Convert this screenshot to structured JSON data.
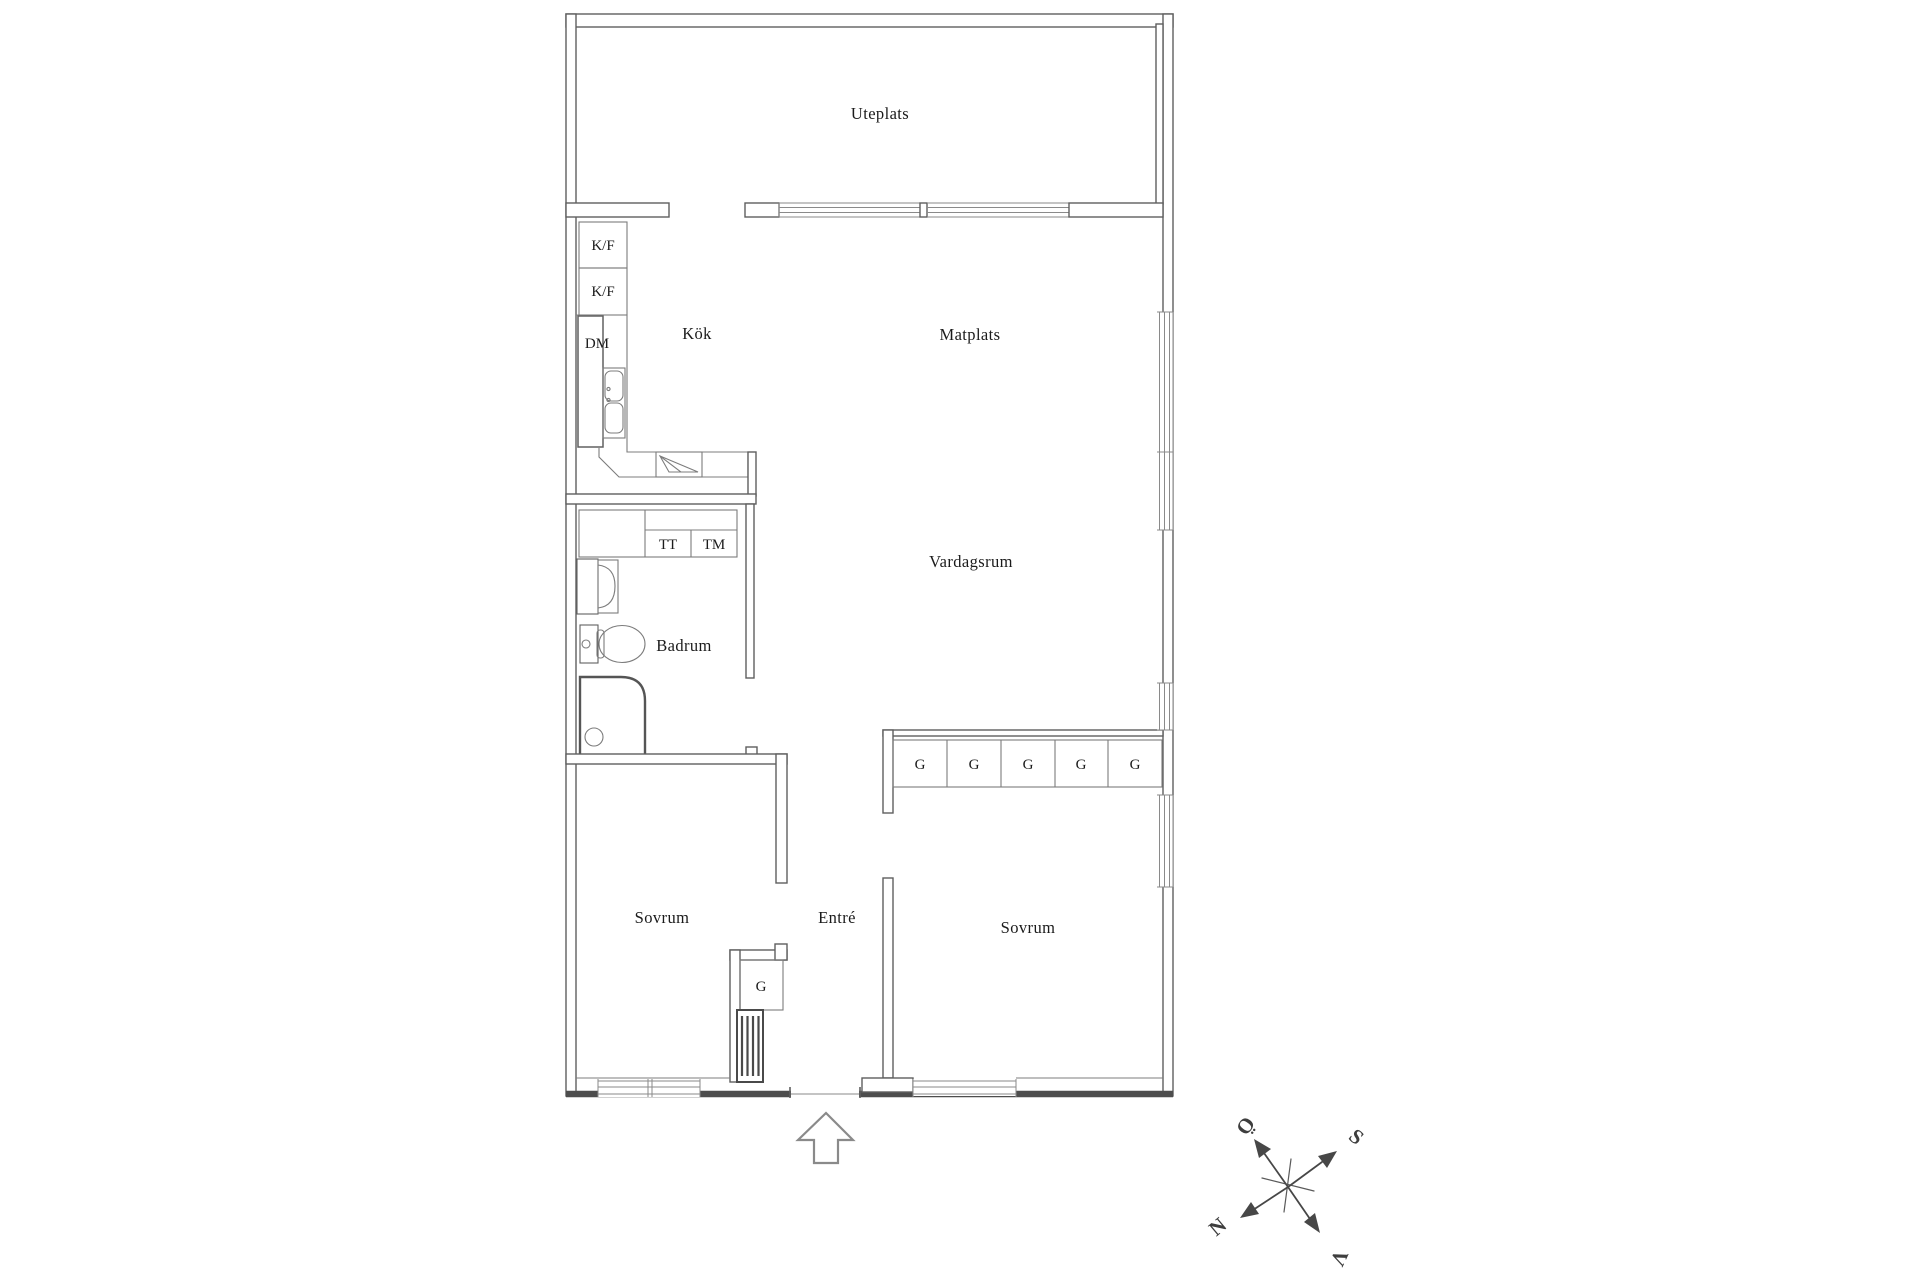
{
  "rooms": {
    "uteplats": "Uteplats",
    "kok": "Kök",
    "matplats": "Matplats",
    "vardagsrum": "Vardagsrum",
    "badrum": "Badrum",
    "sovrum_left": "Sovrum",
    "entre": "Entré",
    "sovrum_right": "Sovrum"
  },
  "appliances": {
    "kf_top": "K/F",
    "kf_bottom": "K/F",
    "dm": "DM",
    "tt": "TT",
    "tm": "TM"
  },
  "wardrobes": {
    "hall_1": "G",
    "hall_2": "G",
    "hall_3": "G",
    "hall_4": "G",
    "hall_5": "G",
    "entre": "G"
  },
  "compass": {
    "north": "N",
    "south": "S",
    "east": "Ö",
    "west": "V"
  },
  "colors": {
    "background": "#ffffff",
    "wall_line": "#5f5f5f",
    "thin_line": "#7c7c7c",
    "text": "#1b1b1b",
    "compass": "#3e3e3e"
  }
}
